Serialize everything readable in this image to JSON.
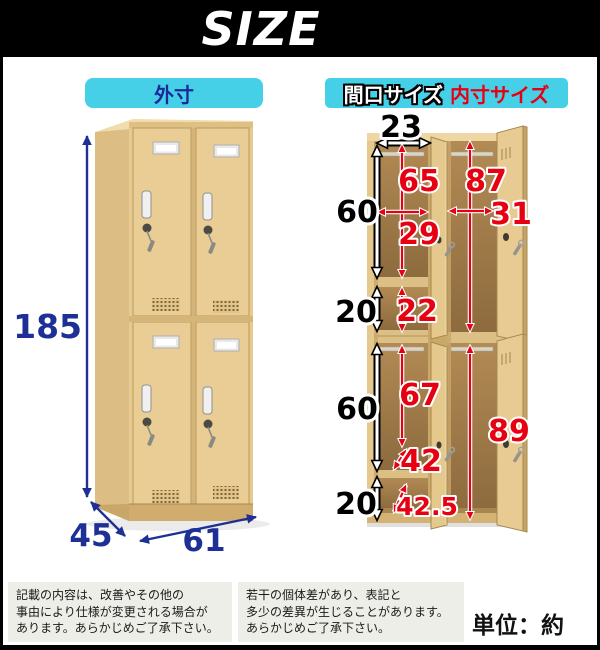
{
  "title": "SIZE",
  "labels": {
    "outer": "外寸",
    "opening": "間口サイズ",
    "inner": "内寸サイズ"
  },
  "measurements": {
    "outer": {
      "height": "185",
      "depth": "45",
      "width": "61"
    },
    "opening": {
      "top_width": "23",
      "upper_door": "60",
      "upper_small": "20",
      "lower_door": "60",
      "lower_small": "20"
    },
    "inner": {
      "upper_height": "65",
      "upper_width": "29",
      "right_upper_height": "87",
      "right_upper_width": "31",
      "upper_small_height": "22",
      "lower_height": "67",
      "lower_depth": "42",
      "right_lower_height": "89",
      "bottom_depth": "42.5"
    }
  },
  "notes": {
    "left": [
      "記載の内容は、改善やその他の",
      "事由により仕様が変更される場合が",
      "あります。あらかじめご了承下さい。"
    ],
    "right": [
      "若干の個体差があり、表記と",
      "多少の差異が生じることがあります。",
      "あらかじめご了承下さい。"
    ]
  },
  "unit": "単位：約cm",
  "colors": {
    "accent_cyan": "#45d0e8",
    "dimension_blue": "#1e3096",
    "dimension_red": "#e60012",
    "wood_front": "#e7ca90",
    "banner_black": "#000000"
  }
}
